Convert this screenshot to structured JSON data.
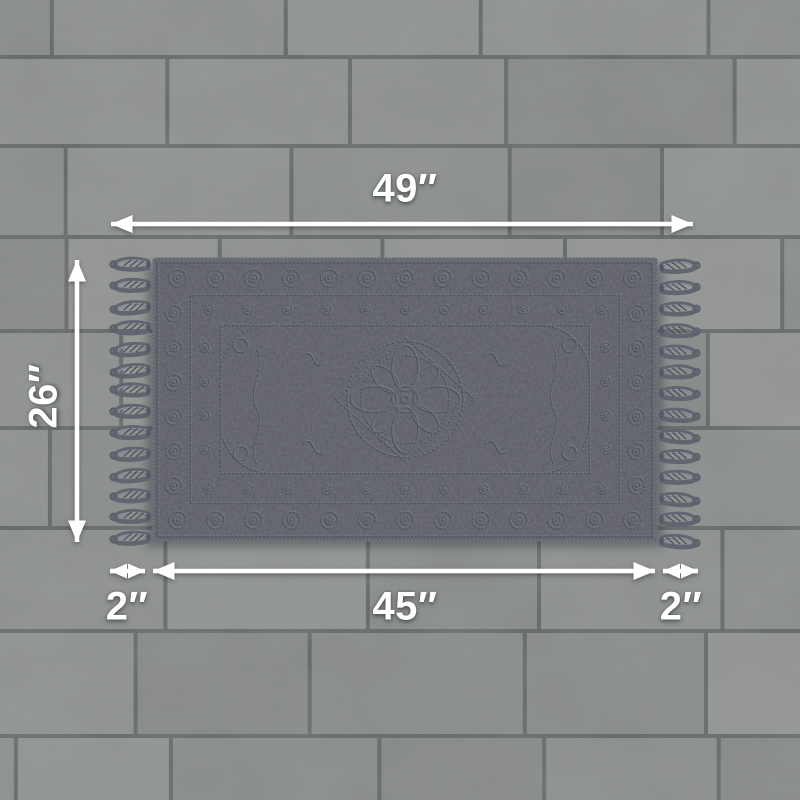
{
  "scene": {
    "description": "Overhead product dimension diagram: dark gray textured rug with tasseled fringe lying on a gray ceramic tile floor",
    "floor": "gray rectangular ceramic tiles, running bond",
    "rug": "dark gray jacquard medallion rug with loop fringe tassels on left and right sides"
  },
  "labels": {
    "total_width": "49″",
    "rug_height": "26″",
    "left_fringe": "2″",
    "body_width": "45″",
    "right_fringe": "2″"
  },
  "colors": {
    "annotation": "#ffffff",
    "rug_base": "#5b5c65",
    "floor_tile": "#8b8e8c",
    "grout": "#5f6362"
  }
}
